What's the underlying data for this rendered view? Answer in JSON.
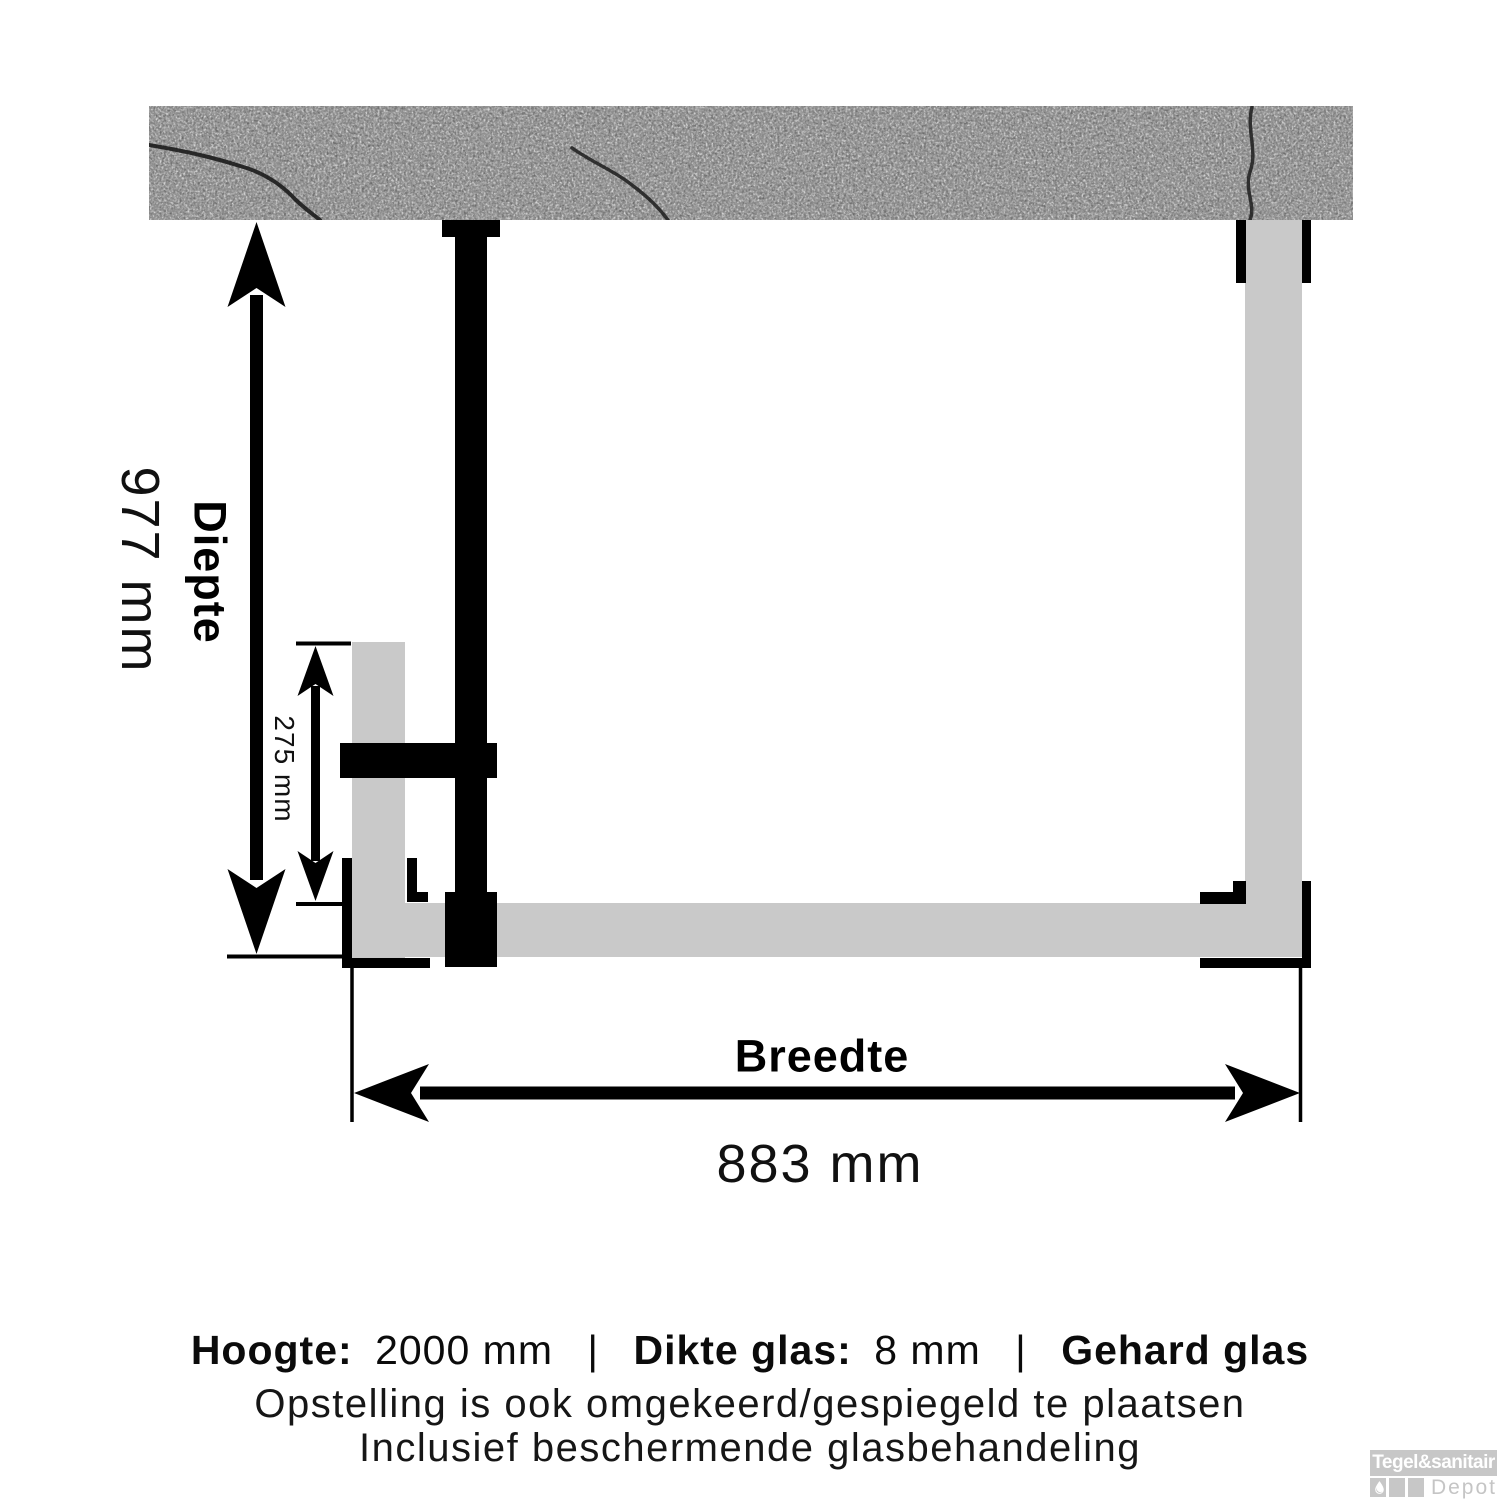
{
  "diagram": {
    "type": "shower-enclosure-top-view-dimension-drawing",
    "dimensions": {
      "depth": {
        "label": "Diepte",
        "value": "977 mm"
      },
      "inner_depth": {
        "value": "275 mm"
      },
      "width": {
        "label": "Breedte",
        "value": "883 mm"
      }
    },
    "colors": {
      "glass": "#c9c9c9",
      "profile": "#000000",
      "wall_base": "#767676",
      "crack": "#1c1c1c",
      "background": "#ffffff"
    }
  },
  "footer": {
    "separator": "|",
    "specs": [
      {
        "label": "Hoogte:",
        "value": "2000 mm"
      },
      {
        "label": "Dikte glas:",
        "value": "8 mm"
      },
      {
        "label": "Gehard glas",
        "value": ""
      }
    ],
    "note1": "Opstelling is ook omgekeerd/gespiegeld te plaatsen",
    "note2": "Inclusief beschermende glasbehandeling"
  },
  "logo": {
    "brand": "Tegel&sanitair",
    "sub": "Depot",
    "icon": "water-drop",
    "gray": "#c7c7c7"
  }
}
